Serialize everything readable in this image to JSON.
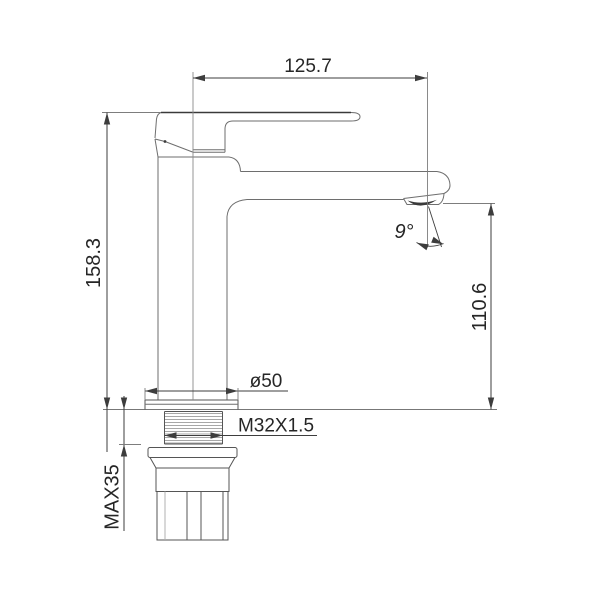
{
  "drawing": {
    "subject": "single-lever basin faucet side elevation technical drawing",
    "labels": {
      "spout_reach": "125.7",
      "overall_height": "158.3",
      "spout_height": "110.6",
      "spout_angle": "9°",
      "flange_diameter": "ø50",
      "thread_spec": "M32X1.5",
      "max_deck_thickness": "MAX35"
    },
    "colors": {
      "background": "#ffffff",
      "outline": "#6e6e6e",
      "dimension": "#3d3d3d",
      "text": "#262626"
    }
  }
}
